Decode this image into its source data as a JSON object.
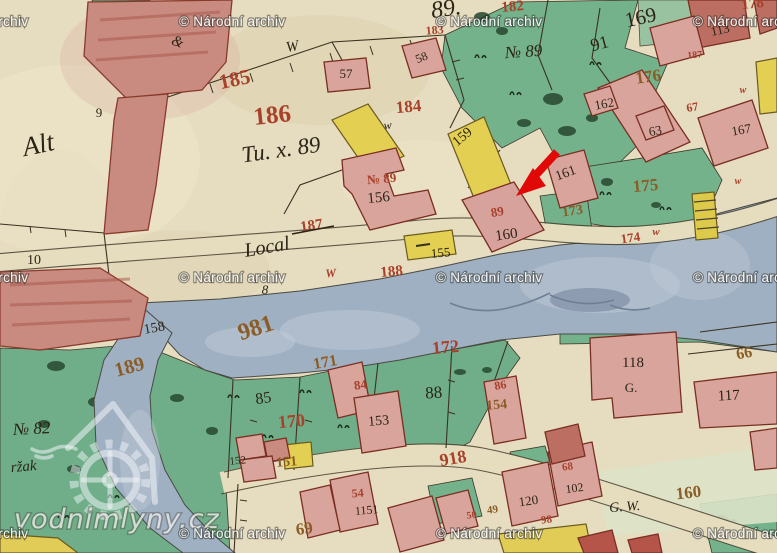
{
  "watermarks": {
    "archive_notice": "© Národní archiv",
    "logo_text": "vodnimlyny.cz"
  },
  "annotation": {
    "arrow_color": "#e10808"
  },
  "palette": {
    "parchment": "#e6dcc0",
    "meadow": "#74b28c",
    "water": "#9fb0c2",
    "building_pink": "#d9a49c",
    "building_red": "#bd6e62",
    "road_yellow": "#e3cf52",
    "ink_black": "#2b2417",
    "ink_red": "#a8402a",
    "ink_brown": "#8a5c26",
    "watermark_text": "#ffffff"
  },
  "labels": [
    {
      "t": "&",
      "ink": "black"
    },
    {
      "t": "89.",
      "ink": "black"
    },
    {
      "t": "169",
      "ink": "black"
    },
    {
      "t": "91",
      "ink": "black"
    },
    {
      "t": "113",
      "ink": "black"
    },
    {
      "t": "182",
      "ink": "red"
    },
    {
      "t": "183",
      "ink": "red"
    },
    {
      "t": "№ 89",
      "ink": "black"
    },
    {
      "t": "185",
      "ink": "red"
    },
    {
      "t": "186",
      "ink": "red"
    },
    {
      "t": "184",
      "ink": "red"
    },
    {
      "t": "57",
      "ink": "black"
    },
    {
      "t": "58",
      "ink": "black"
    },
    {
      "t": "W",
      "ink": "black"
    },
    {
      "t": "w",
      "ink": "black"
    },
    {
      "t": "Tu. x. 89",
      "ink": "black"
    },
    {
      "t": "Alt",
      "ink": "black"
    },
    {
      "t": "9",
      "ink": "black"
    },
    {
      "t": "10",
      "ink": "black"
    },
    {
      "t": "156",
      "ink": "black"
    },
    {
      "t": "№ 89",
      "ink": "red"
    },
    {
      "t": "159",
      "ink": "black"
    },
    {
      "t": "187",
      "ink": "red"
    },
    {
      "t": "Local",
      "ink": "black"
    },
    {
      "t": "8",
      "ink": "black"
    },
    {
      "t": "188",
      "ink": "red"
    },
    {
      "t": "W",
      "ink": "red"
    },
    {
      "t": "89",
      "ink": "red"
    },
    {
      "t": "160",
      "ink": "black"
    },
    {
      "t": "161",
      "ink": "black"
    },
    {
      "t": "162",
      "ink": "black"
    },
    {
      "t": "63",
      "ink": "black"
    },
    {
      "t": "167",
      "ink": "black"
    },
    {
      "t": "67",
      "ink": "red"
    },
    {
      "t": "187",
      "ink": "red"
    },
    {
      "t": "178",
      "ink": "red"
    },
    {
      "t": "176",
      "ink": "brown"
    },
    {
      "t": "175",
      "ink": "brown"
    },
    {
      "t": "173",
      "ink": "brown"
    },
    {
      "t": "174",
      "ink": "red"
    },
    {
      "t": "w",
      "ink": "red"
    },
    {
      "t": "160",
      "ink": "brown"
    },
    {
      "t": "G. W.",
      "ink": "black"
    },
    {
      "t": "118",
      "ink": "black"
    },
    {
      "t": "G.",
      "ink": "black"
    },
    {
      "t": "117",
      "ink": "black"
    },
    {
      "t": "66",
      "ink": "brown"
    },
    {
      "t": "981",
      "ink": "brown"
    },
    {
      "t": "189",
      "ink": "brown"
    },
    {
      "t": "158",
      "ink": "black"
    },
    {
      "t": "171",
      "ink": "brown"
    },
    {
      "t": "172",
      "ink": "red"
    },
    {
      "t": "85",
      "ink": "black"
    },
    {
      "t": "88",
      "ink": "black"
    },
    {
      "t": "170",
      "ink": "red"
    },
    {
      "t": "84",
      "ink": "red"
    },
    {
      "t": "153",
      "ink": "black"
    },
    {
      "t": "86",
      "ink": "red"
    },
    {
      "t": "154",
      "ink": "brown"
    },
    {
      "t": "152",
      "ink": "black"
    },
    {
      "t": "151",
      "ink": "brown"
    },
    {
      "t": "№ 82",
      "ink": "black"
    },
    {
      "t": "ržak",
      "ink": "black"
    },
    {
      "t": "918",
      "ink": "red"
    },
    {
      "t": "54",
      "ink": "red"
    },
    {
      "t": "1151",
      "ink": "black"
    },
    {
      "t": "69",
      "ink": "brown"
    },
    {
      "t": "50",
      "ink": "red"
    },
    {
      "t": "49",
      "ink": "brown"
    },
    {
      "t": "120",
      "ink": "black"
    },
    {
      "t": "102",
      "ink": "black"
    },
    {
      "t": "68",
      "ink": "red"
    },
    {
      "t": "98",
      "ink": "red"
    },
    {
      "t": "w",
      "ink": "red"
    },
    {
      "t": "w",
      "ink": "red"
    },
    {
      "t": "155",
      "ink": "black"
    }
  ]
}
